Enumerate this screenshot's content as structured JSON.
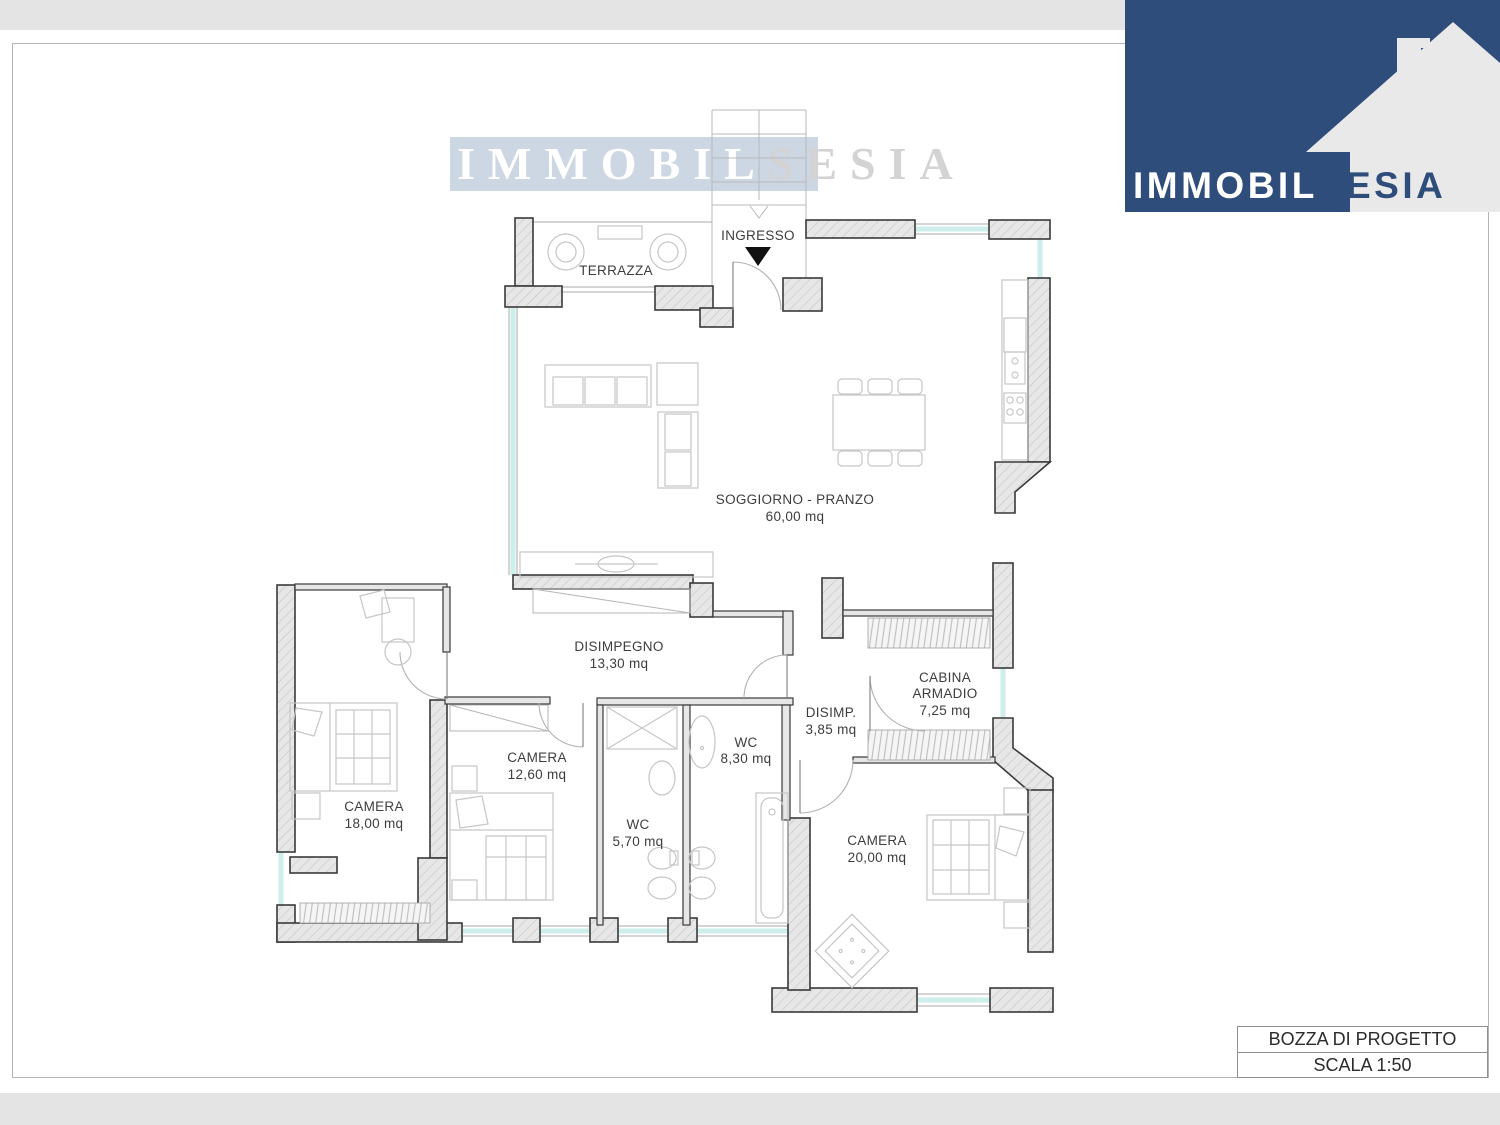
{
  "watermark": {
    "part1": "IMMOBIL",
    "part2": "SESIA"
  },
  "logo": {
    "part1": "IMMOBIL",
    "part2": "SESIA"
  },
  "title_block": {
    "line1": "BOZZA DI PROGETTO",
    "line2": "SCALA 1:50"
  },
  "plan_labels": {
    "terrazza": {
      "name": "TERRAZZA"
    },
    "ingresso": {
      "name": "INGRESSO"
    },
    "soggiorno": {
      "name": "SOGGIORNO - PRANZO",
      "area": "60,00 mq"
    },
    "disimpegno": {
      "name": "DISIMPEGNO",
      "area": "13,30 mq"
    },
    "cabina": {
      "line1": "CABINA",
      "line2": "ARMADIO",
      "area": "7,25  mq"
    },
    "disimp": {
      "name": "DISIMP.",
      "area": "3,85 mq"
    },
    "wc_grande": {
      "name": "WC",
      "area": "8,30  mq"
    },
    "camera18": {
      "name": "CAMERA",
      "area": "18,00  mq"
    },
    "camera12": {
      "name": "CAMERA",
      "area": "12,60  mq"
    },
    "wc_piccolo": {
      "name": "WC",
      "area": "5,70  mq"
    },
    "camera20": {
      "name": "CAMERA",
      "area": "20,00  mq"
    }
  },
  "colors": {
    "logo_blue": "#2e4d7b",
    "logo_house": "#e9e9e9",
    "watermark_bg": "#ccd7e3",
    "window_line": "#cdeeea",
    "wall_outline": "#3a3a3a",
    "furniture": "#c6c6c6"
  }
}
